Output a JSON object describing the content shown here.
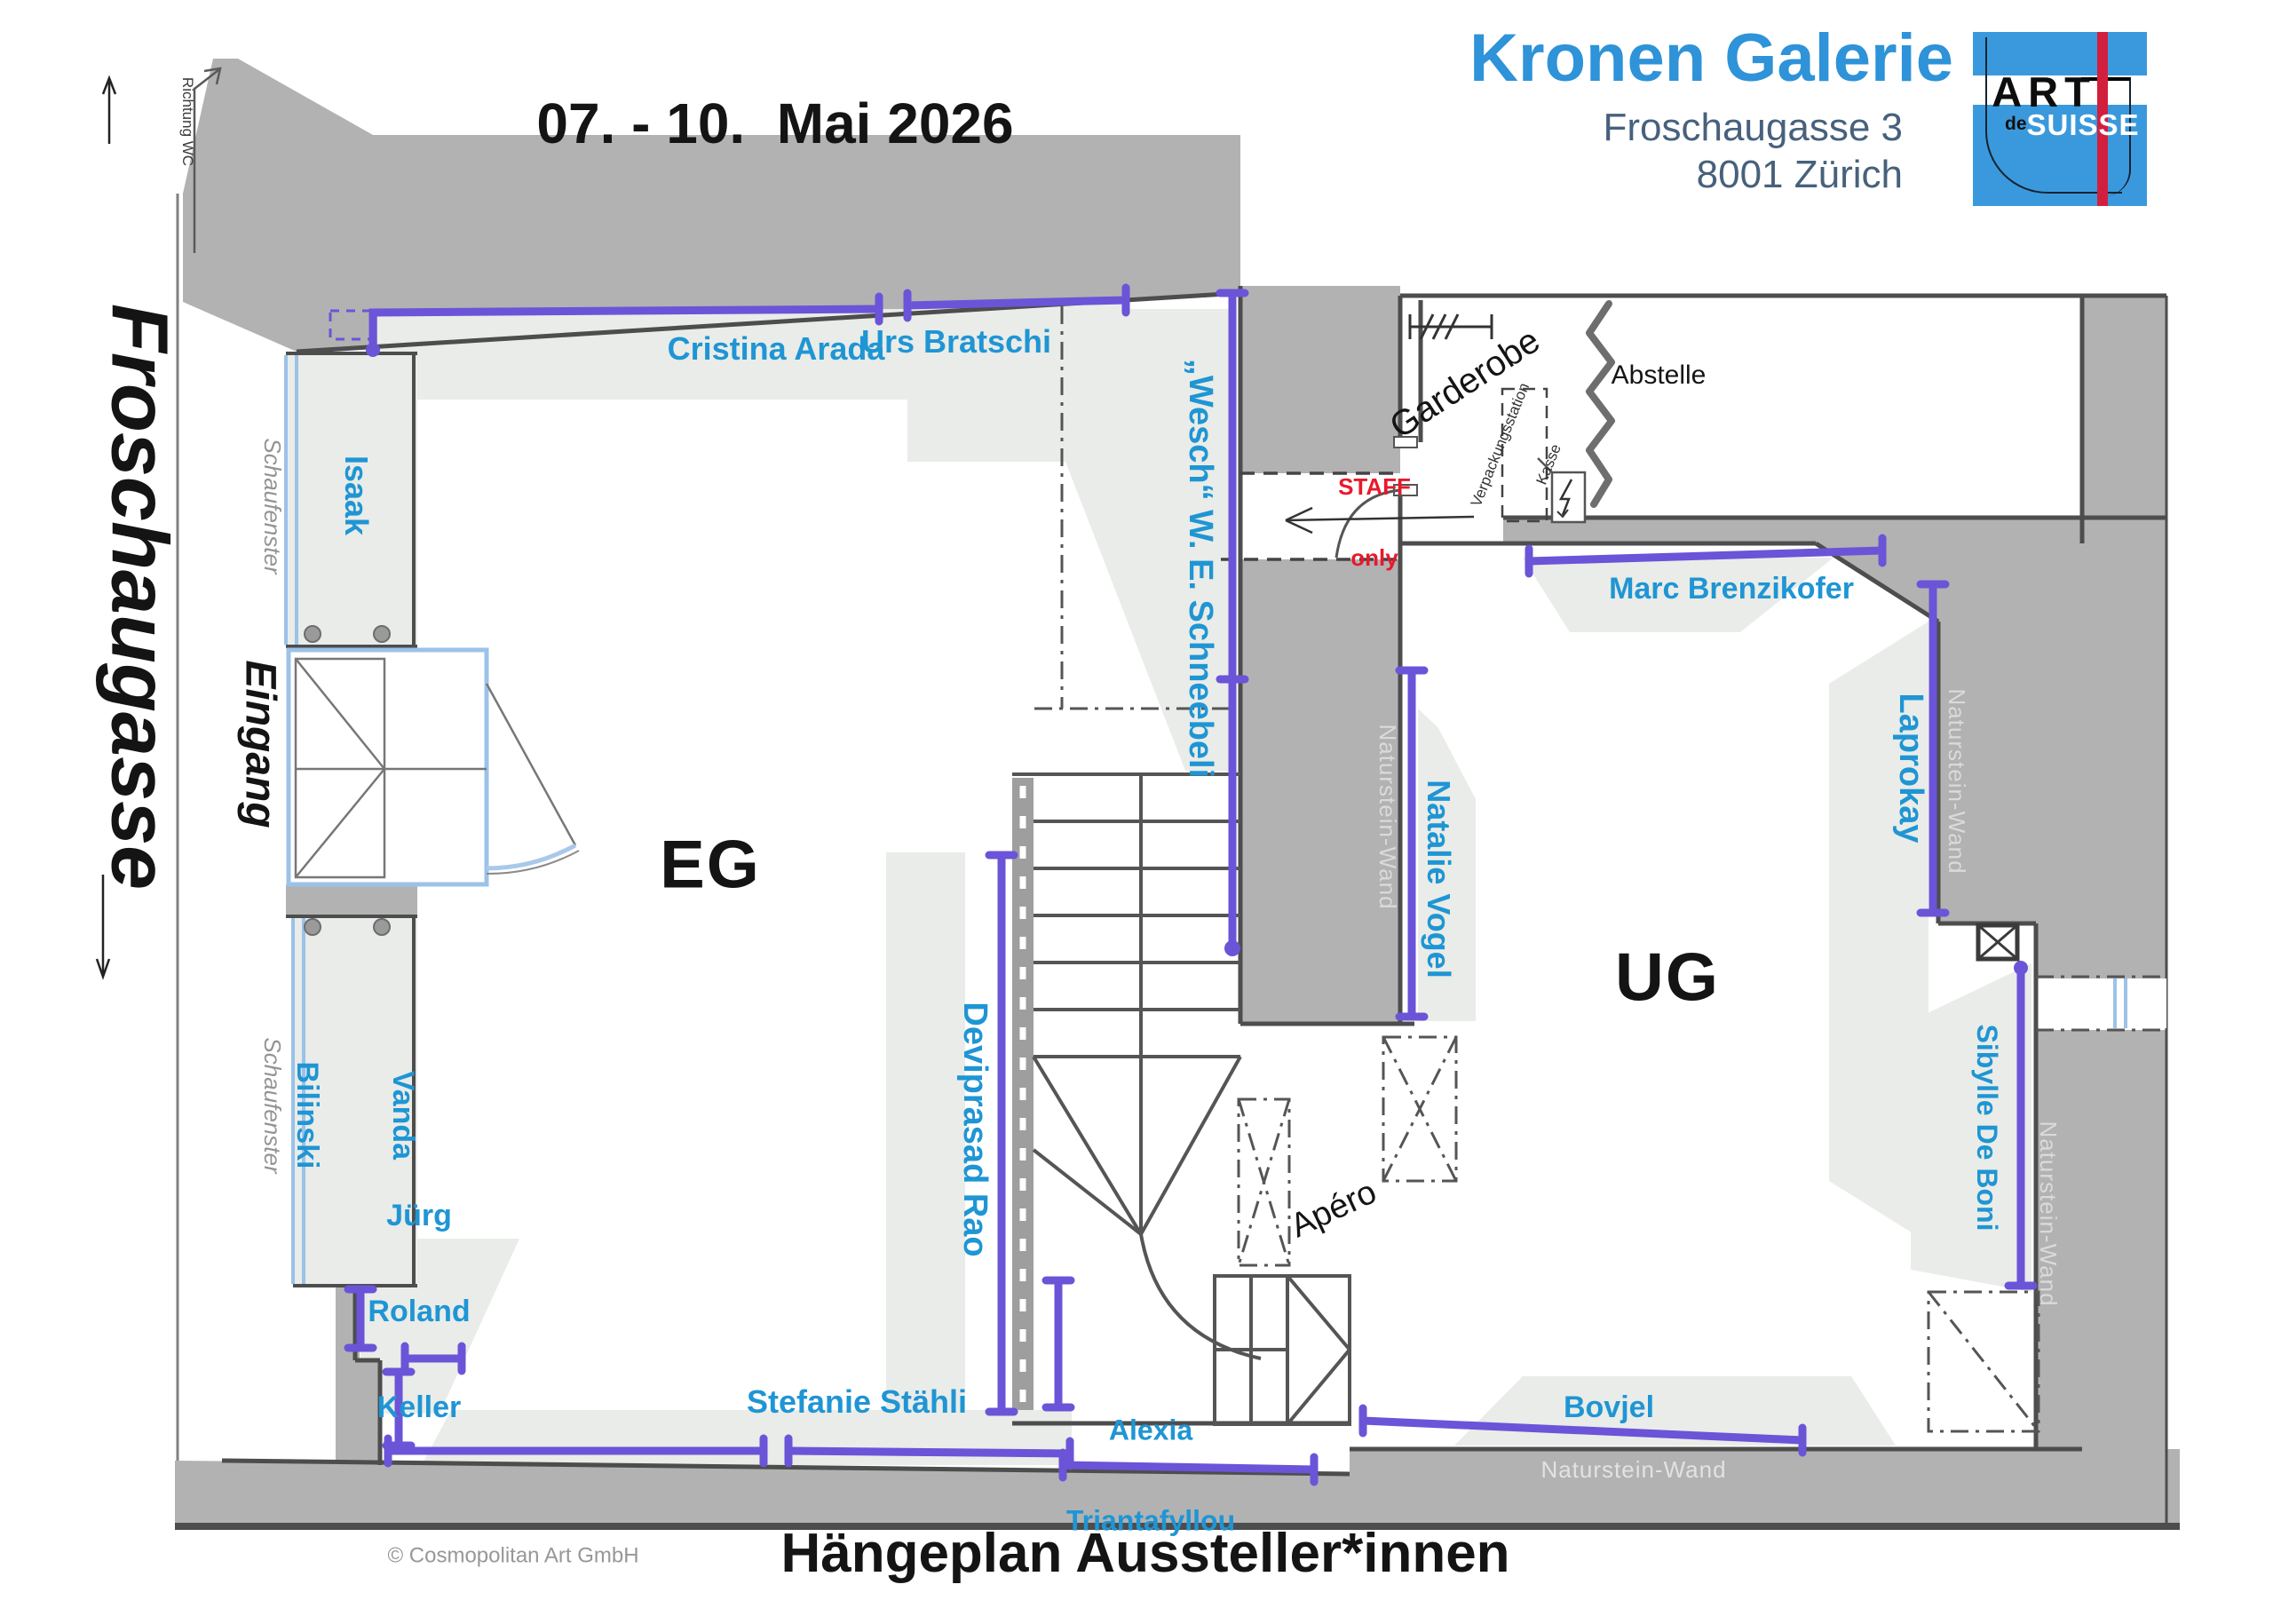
{
  "header": {
    "date_range": "07. - 10.  Mai 2026",
    "gallery_name": "Kronen Galerie",
    "address_line1": "Froschaugasse 3",
    "address_line2": "8001 Zürich",
    "logo": {
      "art": "ART",
      "de": "de",
      "suisse": "SUISSE"
    }
  },
  "street": {
    "name": "Froschaugasse",
    "direction_note": "Richtung WC"
  },
  "floor_labels": {
    "ground": "EG",
    "basement": "UG"
  },
  "exhibitors": {
    "cristina_arada": "Cristina Arada",
    "urs_bratschi": "Urs Bratschi",
    "isaak": "Isaak",
    "vanda_line1": "Vanda",
    "vanda_line2": "Bilinski",
    "juerg_line1": "Jürg",
    "juerg_line2": "Roland",
    "juerg_line3": "Keller",
    "stefanie_staehli": "Stefanie Stähli",
    "deviprasad_rao": "Deviprasad Rao",
    "alexia_line1": "Alexia",
    "alexia_line2": "Triantafyllou",
    "wesch_schneebeli": "„Wesch“ W. E. Schneebeli",
    "natalie_vogel": "Natalie Vogel",
    "marc_brenzikofer": "Marc Brenzikofer",
    "laprokay": "Laprokay",
    "sibylle_de_boni": "Sibylle De Boni",
    "bovjel": "Bovjel"
  },
  "rooms": {
    "entrance": "Eingang",
    "shop_window": "Schaufenster",
    "wardrobe": "Garderobe",
    "storage": "Abstelle",
    "apero": "Apéro",
    "staff_line1": "STAFF",
    "staff_line2": "only",
    "packing_line1": "Verpackungsstation",
    "packing_line2": "Kasse",
    "stone_wall": "Naturstein-Wand"
  },
  "footer": {
    "copyright": "© Cosmopolitan Art GmbH",
    "plan_title": "Hängeplan Aussteller*innen"
  },
  "colors": {
    "exhibitor": "#1f95d4",
    "line": "#6b54d8",
    "staff": "#e8192c",
    "logo": "#3a99dc",
    "brand": "#2e93d8",
    "address": "#47617c",
    "wall": "#b2b2b2"
  }
}
